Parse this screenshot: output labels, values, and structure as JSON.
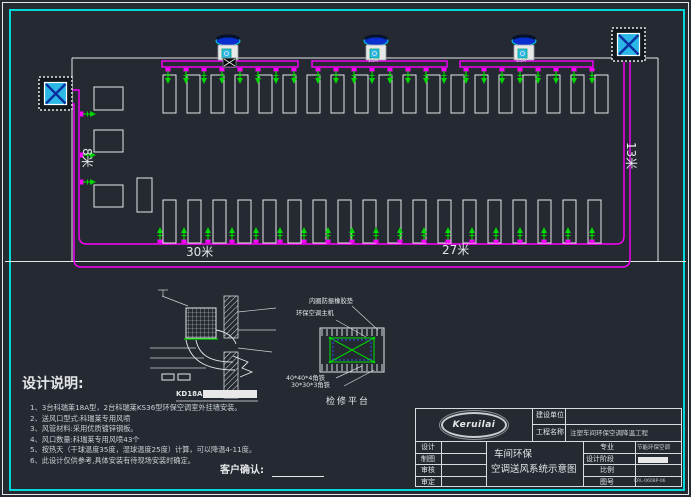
{
  "colors": {
    "background": "#242932",
    "frame_cyan": "#00d9d9",
    "line_white": "#e8e8e8",
    "duct_magenta": "#ff00ff",
    "outlet_green": "#00d400",
    "unit_cyan": "#2bb8e6",
    "unit_blue": "#0a2fd0"
  },
  "plan": {
    "dim_bottom_left": "30米",
    "dim_bottom_right": "27米",
    "dim_right": "13米",
    "dim_left": "8米",
    "roof_unit_label": "18A"
  },
  "detail": {
    "label": "KD18A"
  },
  "platform": {
    "callout_pad": "内圈防振橡胶垫",
    "callout_host": "环保空调主机",
    "callout_angle_large": "40*40*4角铁",
    "callout_angle_small": "30*30*3角铁",
    "caption": "检修平台"
  },
  "notes": {
    "title": "设计说明:",
    "items": [
      "1、3台科瑞莱18A型，2台科瑞莱KS36型环保空调室外挂墙安装。",
      "2、送风口型式:科瑞莱专用风喷",
      "3、风管材料:采用优质镀锌钢板。",
      "4、风口数量:科瑞莱专用风喷43个",
      "5、按热天（干球温度35度，湿球温度25度）计算，可以降温4-11度。",
      "6、此设计仅供参考,具体安装有待现场安装时确定。"
    ]
  },
  "confirm_label": "客户确认:",
  "titleblock": {
    "logo": "Keruilai",
    "owner_label": "建设单位",
    "project_label": "工程名称",
    "project_value": "注塑车间环保空调降温工程",
    "sign_rows": [
      "设计",
      "制图",
      "审核",
      "审定"
    ],
    "title_line1": "车间环保",
    "title_line2": "空调送风系统示意图",
    "spec_label": "专业",
    "spec_value": "节能环保空调",
    "stage_label": "设计阶段",
    "scale_label": "比例",
    "scale_value": "",
    "number_label": "图号",
    "number_value": "KRL-0608P-06"
  }
}
